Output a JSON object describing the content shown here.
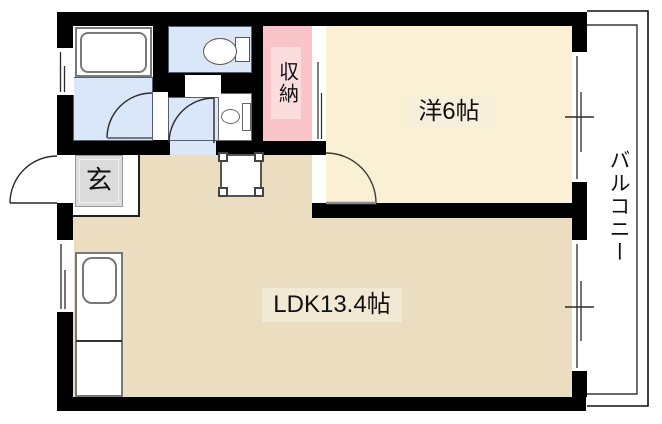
{
  "rooms": {
    "ldk": {
      "label": "LDK13.4帖"
    },
    "western": {
      "label": "洋6帖"
    },
    "storage": {
      "label": "収納"
    },
    "entrance": {
      "label": "玄"
    },
    "balcony": {
      "label": "バルコニー"
    }
  },
  "fixtures": [
    "bathtub",
    "toilet",
    "washbasin",
    "kitchen-counter",
    "kitchen-sink",
    "dining-table",
    "entrance-mat",
    "door-swing-arc",
    "window",
    "balcony-railing"
  ],
  "colors": {
    "wall": "#000000",
    "ldk_floor": "#EADDC0",
    "western_floor": "#FAF0D3",
    "wet_floor": "#D9E7F8",
    "storage_fill": "#F9C5C8",
    "storage_label_bg": "#FBDDDE",
    "entrance_mat": "#DBDBDB",
    "label_bg_western": "#F6EFDC",
    "label_bg_ldk": "#F2E9D5"
  }
}
